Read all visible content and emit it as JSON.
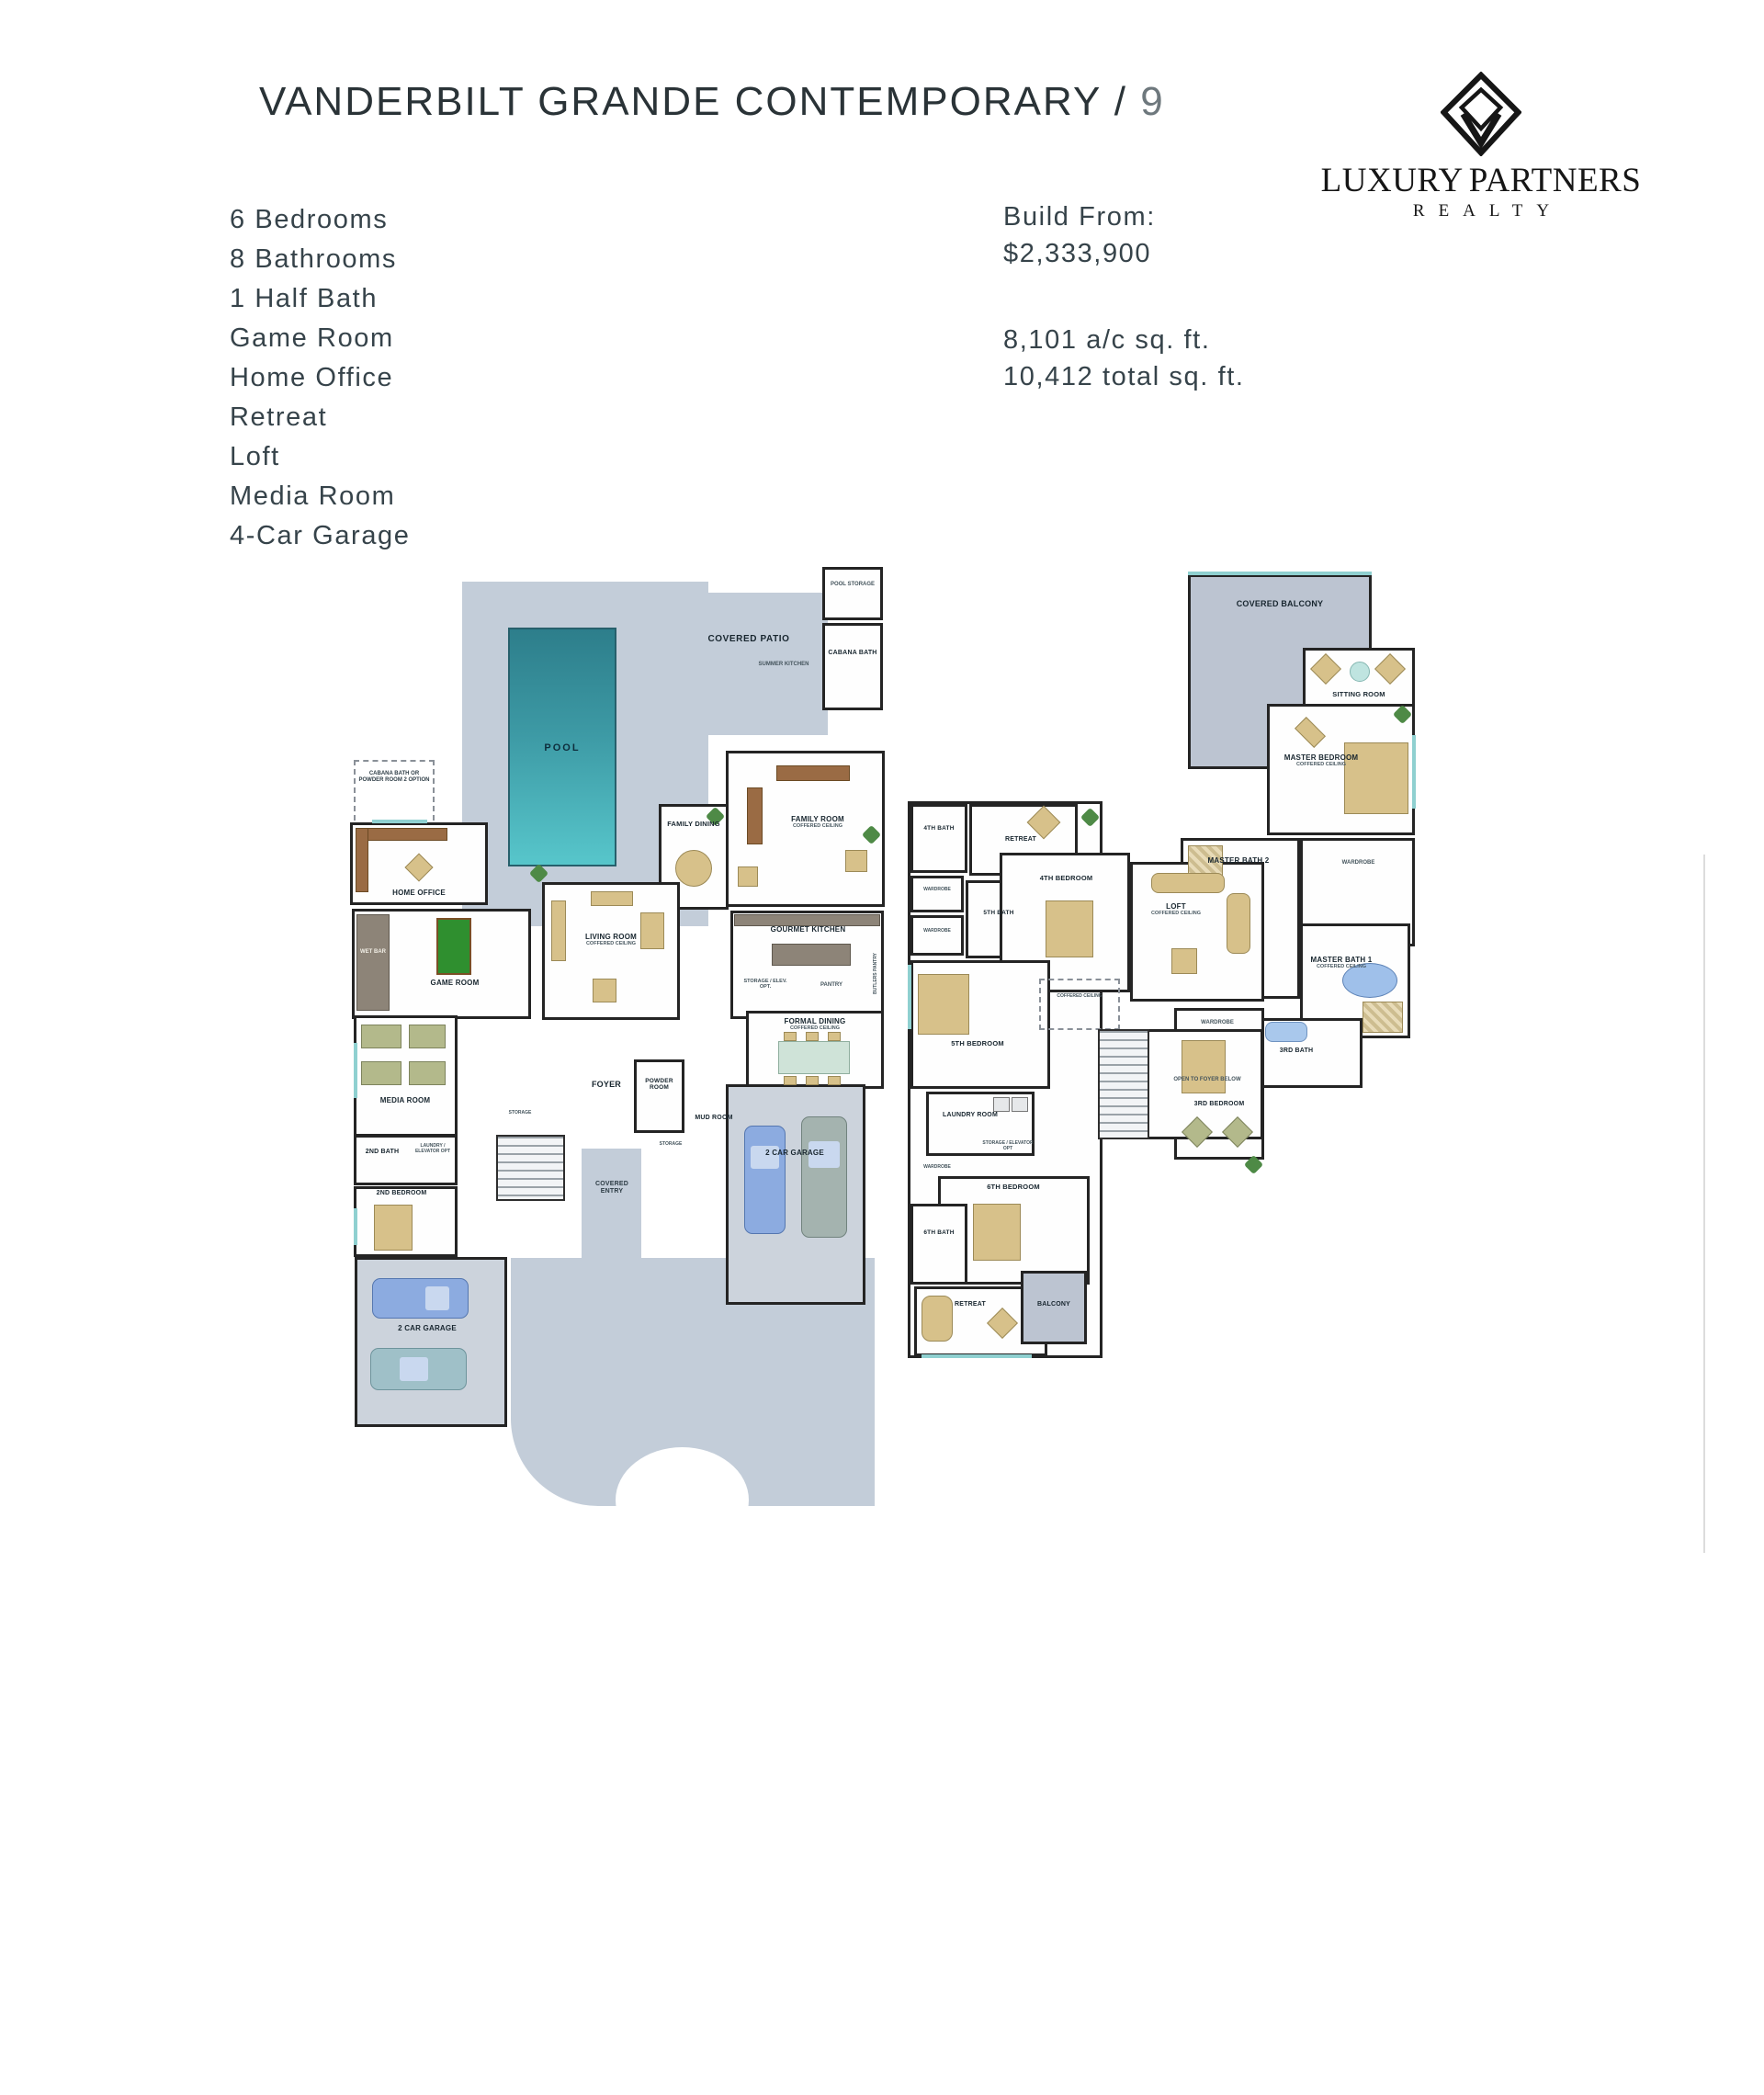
{
  "header": {
    "title": "VANDERBILT GRANDE CONTEMPORARY /",
    "title_truncated": "9",
    "logo": {
      "brand_left": "LUXURY",
      "brand_right": "PARTNERS",
      "brand_sub": "REALTY"
    }
  },
  "features": [
    "6 Bedrooms",
    "8 Bathrooms",
    "1 Half Bath",
    "Game Room",
    "Home Office",
    "Retreat",
    "Loft",
    "Media Room",
    "4-Car Garage"
  ],
  "pricing": {
    "build_from_label": "Build From:",
    "price": "$2,333,900",
    "ac_sqft": "8,101 a/c sq. ft.",
    "total_sqft": "10,412 total sq. ft."
  },
  "colors": {
    "deck": "#c3cdd9",
    "pool_dark": "#2d7e8b",
    "pool_light": "#57c6cb",
    "wall": "#242424",
    "car_blue": "#8cabe0",
    "car_gray": "#a4b3af",
    "furniture_tan": "#d7c18a",
    "pool_table_green": "#2f8f2f"
  },
  "notes": {
    "coffered": "COFFERED CEILING"
  },
  "floor1": {
    "rooms": {
      "pool": "POOL",
      "covered_patio": "COVERED PATIO",
      "pool_storage": "POOL STORAGE",
      "cabana_bath": "CABANA BATH",
      "summer_kitchen": "SUMMER KITCHEN",
      "cabana_option": "CABANA BATH OR POWDER ROOM 2 OPTION",
      "home_office": "HOME OFFICE",
      "family_dining": "FAMILY DINING",
      "family_room": "FAMILY ROOM",
      "wet_bar": "WET BAR",
      "game_room": "GAME ROOM",
      "living_room": "LIVING ROOM",
      "gourmet_kitchen": "GOURMET KITCHEN",
      "storage_elevator": "STORAGE / ELEV. OPT.",
      "pantry": "PANTRY",
      "butlers_pantry": "BUTLERS PANTRY",
      "formal_dining": "FORMAL DINING",
      "media_room": "MEDIA ROOM",
      "bath2": "2ND BATH",
      "laundry_elevator": "LAUNDRY / ELEVATOR OPT",
      "bedroom2": "2ND BEDROOM",
      "foyer": "FOYER",
      "powder_room": "POWDER ROOM",
      "mud_room": "MUD ROOM",
      "storage": "STORAGE",
      "covered_entry": "COVERED ENTRY",
      "garage": "2 CAR GARAGE"
    }
  },
  "floor2": {
    "rooms": {
      "covered_balcony": "COVERED BALCONY",
      "sitting_room": "SITTING ROOM",
      "master_bedroom": "MASTER BEDROOM",
      "master_bath2": "MASTER BATH 2",
      "master_bath1": "MASTER BATH 1",
      "wardrobe": "WARDROBE",
      "bath4": "4TH BATH",
      "retreat": "RETREAT",
      "bedroom4": "4TH BEDROOM",
      "bath5": "5TH BATH",
      "loft": "LOFT",
      "bedroom5": "5TH BEDROOM",
      "laundry_room": "LAUNDRY ROOM",
      "storage_elevator": "STORAGE / ELEVATOR OPT",
      "bedroom6": "6TH BEDROOM",
      "bath6": "6TH BATH",
      "balcony": "BALCONY",
      "bedroom3": "3RD BEDROOM",
      "bath3": "3RD BATH",
      "open_to_foyer": "OPEN TO FOYER BELOW"
    }
  }
}
